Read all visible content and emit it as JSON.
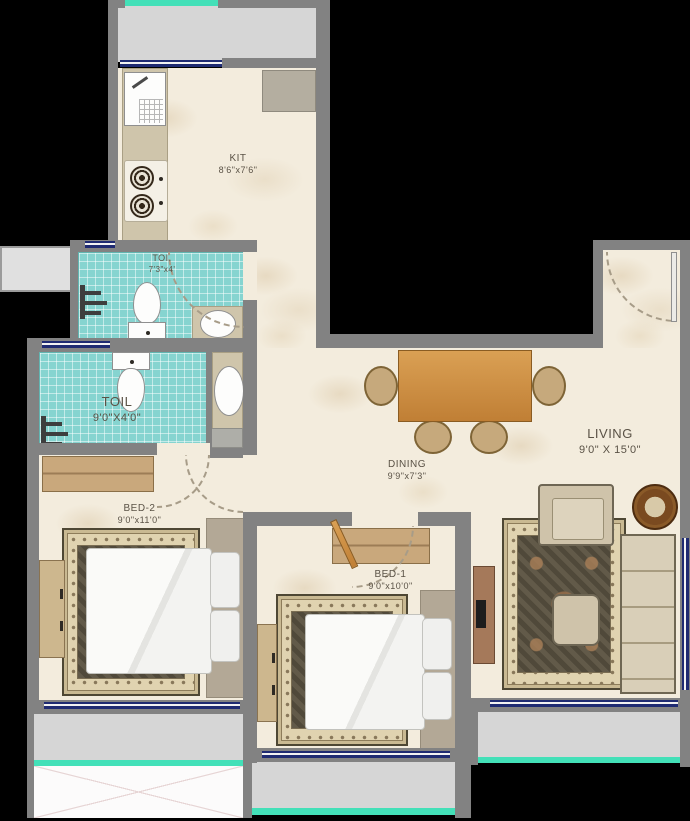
{
  "rooms": {
    "kitchen": {
      "name": "KIT",
      "dims": "8'6\"x7'6\""
    },
    "toilet_top": {
      "name": "TOI.",
      "dims": "7'3\"x4'"
    },
    "toilet_main": {
      "name": "TOIL",
      "dims": "9'0\"X4'0\""
    },
    "dining": {
      "name": "DINING",
      "dims": "9'9\"x7'3\""
    },
    "living": {
      "name": "LIVING",
      "dims": "9'0\" X 15'0\""
    },
    "bed1": {
      "name": "BED-1",
      "dims": "9'0\"x10'0\""
    },
    "bed2": {
      "name": "BED-2",
      "dims": "9'0\"x11'0\""
    }
  },
  "colors": {
    "background": "#000000",
    "wall": "#828282",
    "floor_marble": "#f3ecdd",
    "toilet_tile": "#86d4d0",
    "window_frame": "#1f2b72",
    "balcony_floor": "#d6d6d6",
    "balcony_edge": "#43e0b8",
    "table_wood": "#c8883e"
  }
}
